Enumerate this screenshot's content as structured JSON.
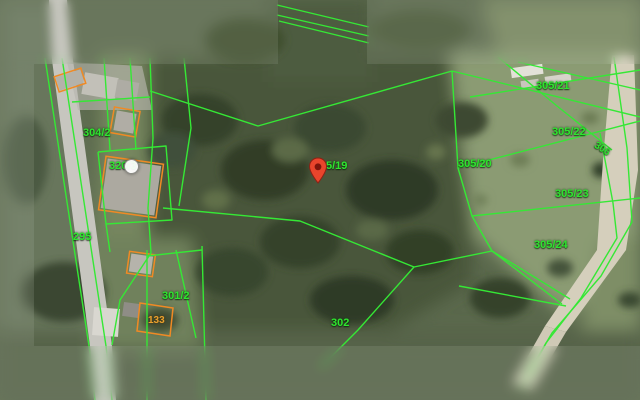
{
  "map": {
    "colors": {
      "parcel_line_green": "#35e835",
      "parcel_label_green": "#2fe42f",
      "building_outline_orange": "#f08a24",
      "building_label_orange": "#e9a12e",
      "marker_red": "#e8452c"
    },
    "icons": [
      "location-pin-icon",
      "circle-marker-icon"
    ],
    "marker": {
      "parcel": "5/19"
    },
    "parcel_labels": [
      {
        "text": "304/2"
      },
      {
        "text": "320/3"
      },
      {
        "text": "295"
      },
      {
        "text": "301/2"
      },
      {
        "text": "302"
      },
      {
        "text": "5/19"
      },
      {
        "text": "305/20"
      },
      {
        "text": "305/21"
      },
      {
        "text": "305/22"
      },
      {
        "text": "305/23"
      },
      {
        "text": "305/24"
      },
      {
        "text": "306"
      }
    ],
    "building_labels": [
      {
        "text": "133"
      }
    ]
  }
}
